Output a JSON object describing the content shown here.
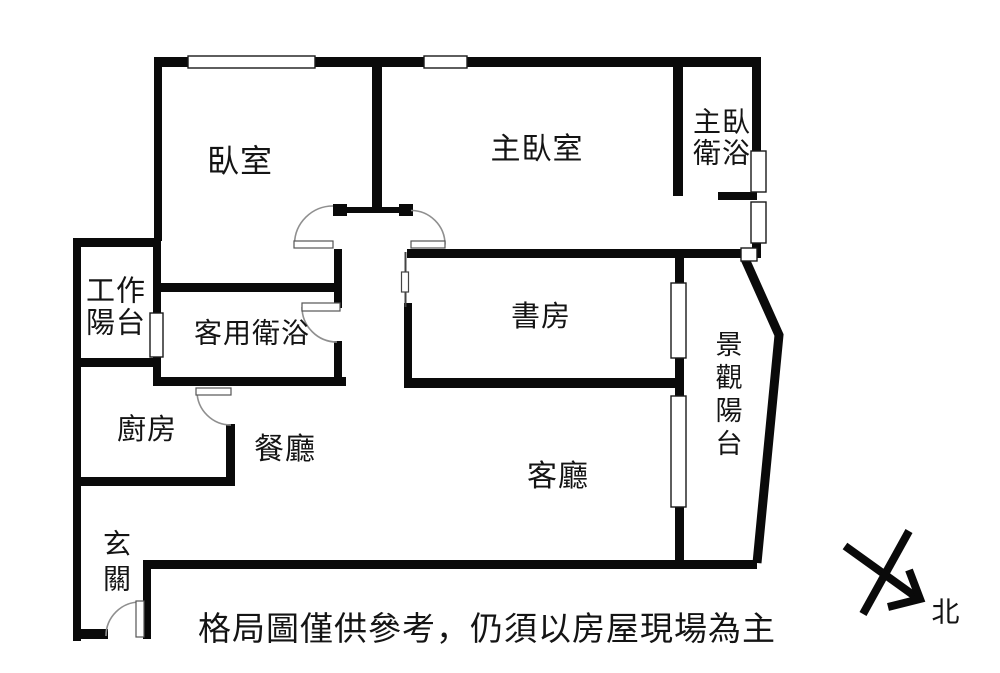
{
  "rooms": {
    "bedroom": "臥室",
    "master_bedroom": "主臥室",
    "master_bathroom": "主臥\n衛浴",
    "work_balcony": "工作\n陽台",
    "guest_bathroom": "客用衛浴",
    "study": "書房",
    "kitchen": "廚房",
    "dining": "餐廳",
    "living": "客廳",
    "view_balcony": "景觀陽台",
    "entry": "玄關"
  },
  "compass": {
    "north": "北"
  },
  "disclaimer": "格局圖僅供參考，仍須以房屋現場為主",
  "colors": {
    "wall": "#0a0a0a",
    "door_arc": "#8f8f8f",
    "door_leaf_border": "#555555",
    "window_border": "#1a1a1a",
    "background": "#ffffff"
  }
}
